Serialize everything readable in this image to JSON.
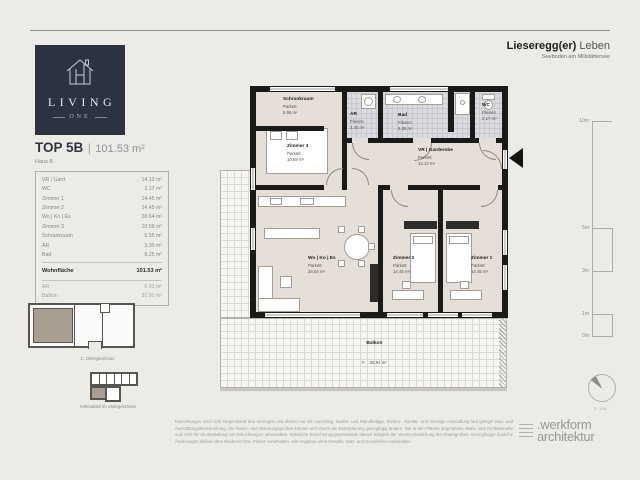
{
  "page": {
    "header": {
      "title_bold": "Lieseregg(er)",
      "title_light": " Leben",
      "subtitle": "Seeboden am Millstättersee"
    },
    "logo": {
      "brand": "LIVING",
      "brand_sub": "ONE"
    },
    "unit": {
      "title": "TOP 5B",
      "separator": "|",
      "area": "101.53 m²",
      "subtitle": "Haus B"
    },
    "room_table": {
      "rows": [
        {
          "name": "VR | Gard.",
          "area": "14.13 m²"
        },
        {
          "name": "WC",
          "area": "2.17 m²"
        },
        {
          "name": "Zimmer 1",
          "area": "14.45 m²"
        },
        {
          "name": "Zimmer 2",
          "area": "14.45 m²"
        },
        {
          "name": "Wo | Ko | Es",
          "area": "28.64 m²"
        },
        {
          "name": "Zimmer 3",
          "area": "10.59 m²"
        },
        {
          "name": "Schrankraum",
          "area": "5.55 m²"
        },
        {
          "name": "AR",
          "area": "3.30 m²"
        },
        {
          "name": "Bad",
          "area": "8.25 m²"
        }
      ],
      "total": {
        "name": "Wohnfläche",
        "area": "101.53 m²"
      },
      "extras": [
        {
          "name": "AR",
          "area": "6.01 m²"
        },
        {
          "name": "Balkon",
          "area": "32.91 m²"
        }
      ]
    },
    "key_plans": {
      "floor_caption": "1. Obergeschoss",
      "cellar_caption": "Kellerabteil im Untergeschoss"
    },
    "plan": {
      "rooms": [
        {
          "name": "Schrankraum",
          "material": "Parkett",
          "area": "5.55 m²"
        },
        {
          "name": "Zimmer 3",
          "material": "Parkett",
          "area": "10.59 m²"
        },
        {
          "name": "AR",
          "material": "Fliesen",
          "area": "3.30 m²"
        },
        {
          "name": "Bad",
          "material": "Fliesen",
          "area": "8.25 m²"
        },
        {
          "name": "WC",
          "material": "Fliesen",
          "area": "2.17 m²"
        },
        {
          "name": "VR | Garderobe",
          "material": "Parkett",
          "area": "14.13 m²"
        },
        {
          "name": "Wo | Ko | Es",
          "material": "Parkett",
          "area": "28.64 m²"
        },
        {
          "name": "Zimmer 2",
          "material": "Parkett",
          "area": "14.45 m²"
        },
        {
          "name": "Zimmer 1",
          "material": "Parkett",
          "area": "14.45 m²"
        },
        {
          "name": "Balkon",
          "material": "F.",
          "area": "32.91 m²"
        }
      ]
    },
    "scale_bar": {
      "labels": [
        "10m",
        "5m",
        "3m",
        "1m",
        "0m"
      ]
    },
    "scale_note": "1 : 100",
    "footer": {
      "disclaimer": "Einrichtungen sind nicht Gegenstand des Vertrages und dienen nur als Vorschlag. Boden- und Wandbeläge, Elektro-, Sanitär- und sonstige Ausstattung laut gültiger Bau- und Ausstattungsbeschreibung. Die Raum- und Wohnungsgrößen können sich durch die Detailplanung geringfügig ändern. Die in den Plänen angeführten Maße sind Rohbaumaße und nicht für die Bestellung von Einrichtungen verwendbar. Sämtliche Einrichtungsgegenstände dienen lediglich der Veranschaulichung der Raumgrößen. Geringfügige bauliche Änderungen bleiben dem Bauherrn bzw. Planer vorbehalten. Alle Angaben ohne Gewähr, Satz- und Druckfehler vorbehalten.",
      "studio_line1": ".werkform",
      "studio_line2": "architektur"
    },
    "colors": {
      "accent_navy": "#2b3240",
      "highlight_taupe": "#a99e90",
      "wall": "#1a1a19"
    }
  }
}
